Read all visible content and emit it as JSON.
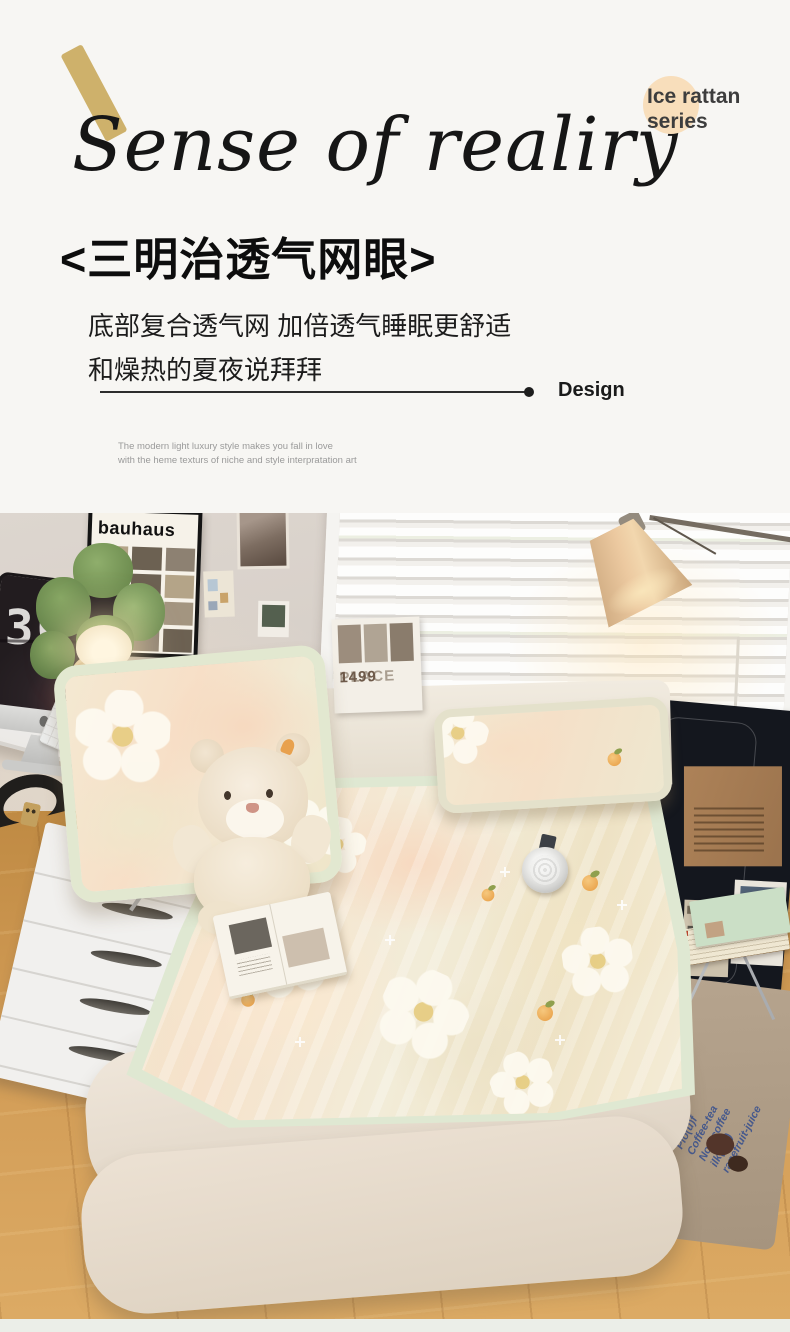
{
  "hero": {
    "title": "Sense of realiry",
    "badge": {
      "line1": "Ice rattan",
      "line2": "series"
    },
    "heading": "<三明治透气网眼>",
    "body_line1": "底部复合透气网 加倍透气睡眠更舒适",
    "body_line2": "和燥热的夏夜说拜拜",
    "design_label": "Design",
    "caption_line1": "The modern light luxury style makes you fall in love",
    "caption_line2": "with the heme texturs of niche and style interpratation art",
    "colors": {
      "accent_gold": "#cbad63",
      "badge_highlight": "#f8debb",
      "background": "#f7f6f3"
    }
  },
  "photo": {
    "poster_title": "bauhaus",
    "clock_digits": "30",
    "wall_card": {
      "word": "PLACE",
      "number": "1499"
    },
    "rug": {
      "line1": "Plo(u)f",
      "line2": "Coffee-tea",
      "line3": "Non-coffee",
      "line4": "ilk(tea)",
      "line5": "rapefruit-juice"
    },
    "colors": {
      "mat_trim": "#dfe8d2",
      "footer_strip": "#ebeee8"
    }
  }
}
